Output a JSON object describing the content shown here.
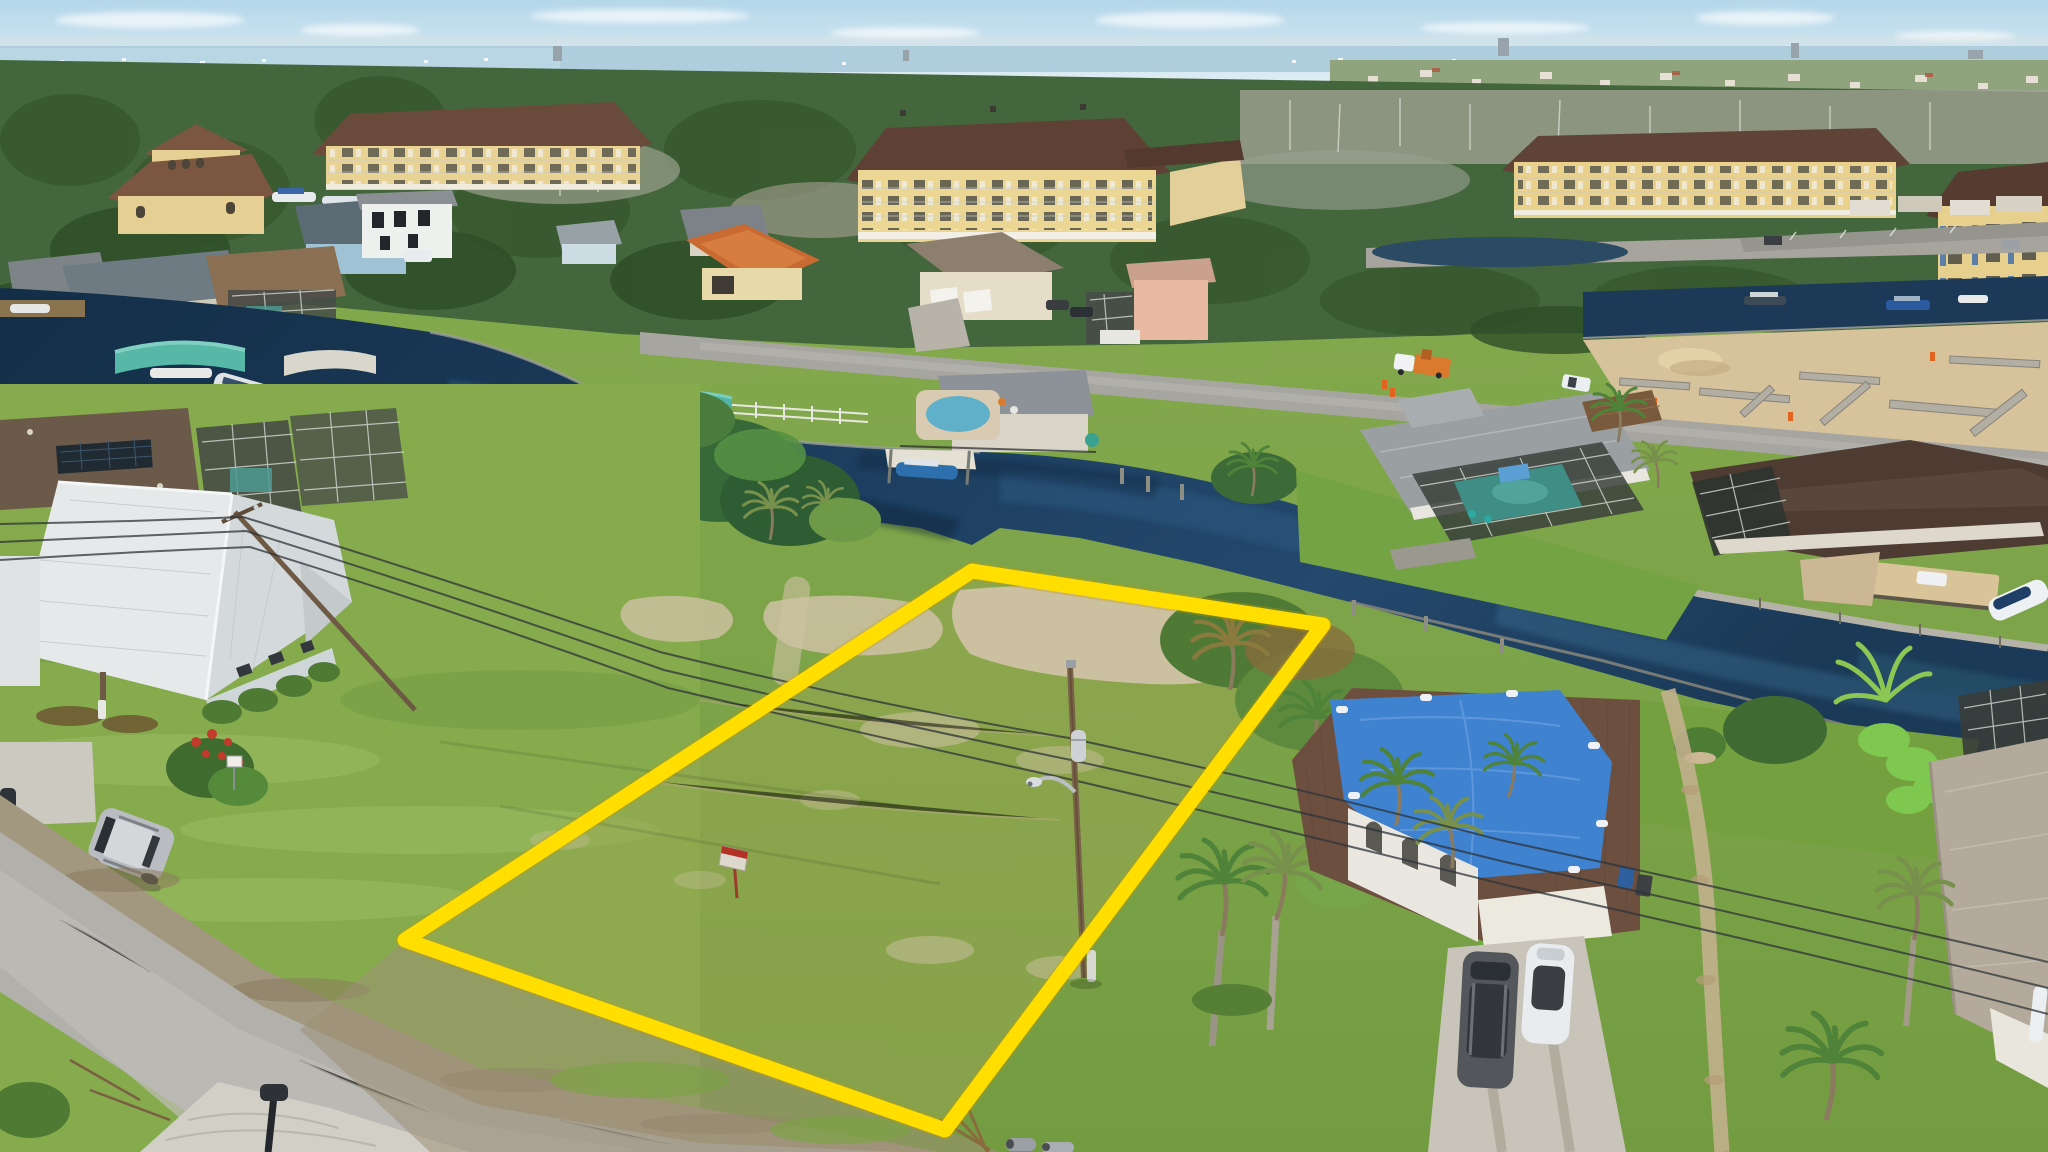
{
  "scene": {
    "type": "aerial-drone-real-estate-photo",
    "subject": "Vacant waterfront lot on a canal, outlined in yellow, in a Florida residential neighborhood",
    "sky": "pale blue with thin clouds above a distant bay and tree line",
    "notable": [
      "yellow condominium buildings with brown hip roofs along the wooded tree line",
      "dark blue canal with seawalls, docks, boat lifts and canopies",
      "single-family homes with screened pool enclosures and metal or tile roofs",
      "vacant grassy lot with sandy patches outlined in bright yellow",
      "street light pole with transformer and power lines crossing the lot",
      "small red and white for-sale sign post inside the lot",
      "house with large blue tarp on its brown roof at lower right",
      "driveway with a dark SUV and a white car",
      "gray residential road at lower left with a parked silver SUV and black mailbox",
      "construction site with concrete block walls and sand at middle right"
    ]
  },
  "lot_outline": {
    "points": "972,571 1323,625 945,1130 405,940",
    "color": "#FFDE00",
    "stroke_width": 15
  },
  "palette": {
    "sky": "#bddcec",
    "bay_water": "#aecddd",
    "woods_green": "#44663c",
    "dead_trees": "#a3a697",
    "canal_water": "#16334f",
    "canal_reflection": "#2d5a82",
    "grass_base": "#7da246",
    "grass_lot": "#99a851",
    "sand_patch": "#cfc2a4",
    "road_asphalt": "#b2b0ab",
    "concrete_driveway": "#d2cfc7",
    "condo_wall": "#e9d394",
    "condo_roof": "#5e4134",
    "orange_tile_roof": "#c96a32",
    "white_metal_roof": "#e6e9ea",
    "blue_tarp": "#3f82cf",
    "teal_boat_canopy": "#57b8a8",
    "silver_suv": "#b9bcc0",
    "outline_yellow": "#FFDE00"
  },
  "objects": [
    {
      "name": "condo-building-1",
      "note": "yellow 4-story condo, left"
    },
    {
      "name": "condo-building-2",
      "note": "yellow 4-story condo, center"
    },
    {
      "name": "condo-building-3",
      "note": "yellow condo, right"
    },
    {
      "name": "condo-building-4",
      "note": "yellow condo at far right edge, blue balcony panels"
    },
    {
      "name": "canal",
      "note": "dark blue water winding left to lower right"
    },
    {
      "name": "vacant-lot",
      "note": "grass with sandy patches, yellow outline"
    },
    {
      "name": "for-sale-sign",
      "note": "tiny red/white sign on post inside lot"
    },
    {
      "name": "street-light-pole",
      "note": "wood pole with transformer and lamp arm inside right lot edge"
    },
    {
      "name": "power-lines",
      "note": "three conductors crossing the lot diagonally"
    },
    {
      "name": "blue-tarp-house",
      "note": "brown metal roof mostly covered by blue tarp"
    },
    {
      "name": "white-metal-roof-house",
      "note": "foreground left house"
    },
    {
      "name": "solar-roof-house",
      "note": "brown shingle roof with solar panels behind foreground house"
    },
    {
      "name": "orange-tile-house",
      "note": "terracotta roof home mid-left"
    },
    {
      "name": "gray-pool-house",
      "note": "gray roof home with screened pool, right of lot"
    },
    {
      "name": "dark-roof-house",
      "note": "dark brown roof home, far right"
    },
    {
      "name": "beige-tile-house",
      "note": "bottom right corner home"
    },
    {
      "name": "construction-site",
      "note": "concrete block walls and sand, middle right"
    },
    {
      "name": "utility-truck",
      "note": "white/orange truck on upper right road"
    },
    {
      "name": "silver-suv",
      "note": "parked on grass shoulder lower left"
    },
    {
      "name": "dark-suv",
      "note": "in blue-tarp house driveway"
    },
    {
      "name": "white-car",
      "note": "in blue-tarp house driveway"
    },
    {
      "name": "mailbox",
      "note": "black mailbox at road edge"
    },
    {
      "name": "boat-lifts",
      "note": "teal and white canopy lifts along canal"
    },
    {
      "name": "pontoon-boats",
      "note": "docked along top right canal"
    },
    {
      "name": "sabal-palms",
      "note": "cluster along east lot edge and yards"
    }
  ]
}
